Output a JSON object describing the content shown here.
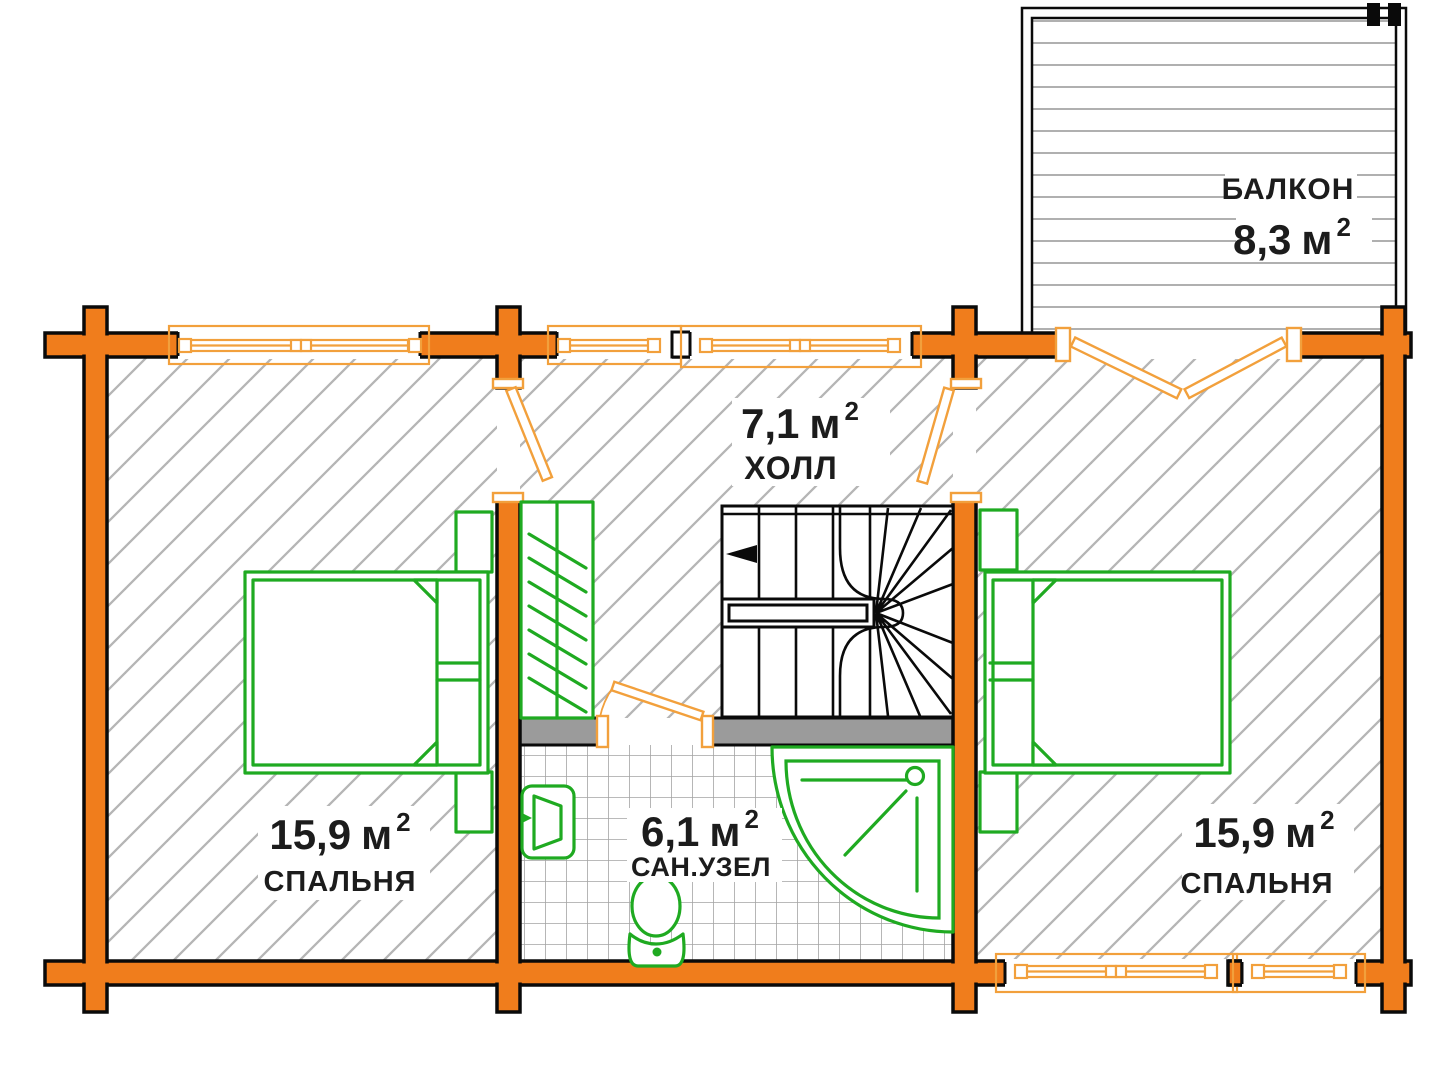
{
  "plan": {
    "title": "floor-plan",
    "rooms": {
      "balcony": {
        "name": "БАЛКОН",
        "area": "8,3",
        "unit": "м",
        "sup": "2"
      },
      "hall": {
        "name": "ХОЛЛ",
        "area": "7,1",
        "unit": "м",
        "sup": "2"
      },
      "bathroom": {
        "name": "САН.УЗЕЛ",
        "area": "6,1",
        "unit": "м",
        "sup": "2"
      },
      "bedroom_left": {
        "name": "СПАЛЬНЯ",
        "area": "15,9",
        "unit": "м",
        "sup": "2"
      },
      "bedroom_right": {
        "name": "СПАЛЬНЯ",
        "area": "15,9",
        "unit": "м",
        "sup": "2"
      }
    },
    "colors": {
      "wall_orange": "#F07D1C",
      "window_orange": "#F2A03C",
      "fixture_green": "#1FAA21",
      "hatch_gray": "#B5B5B5",
      "tile_gray": "#A3A3A3",
      "deck_gray": "#B0B0B0",
      "partition_gray": "#9B9B9B",
      "line_black": "#0A0A0A",
      "text_black": "#1C1C1C"
    }
  }
}
